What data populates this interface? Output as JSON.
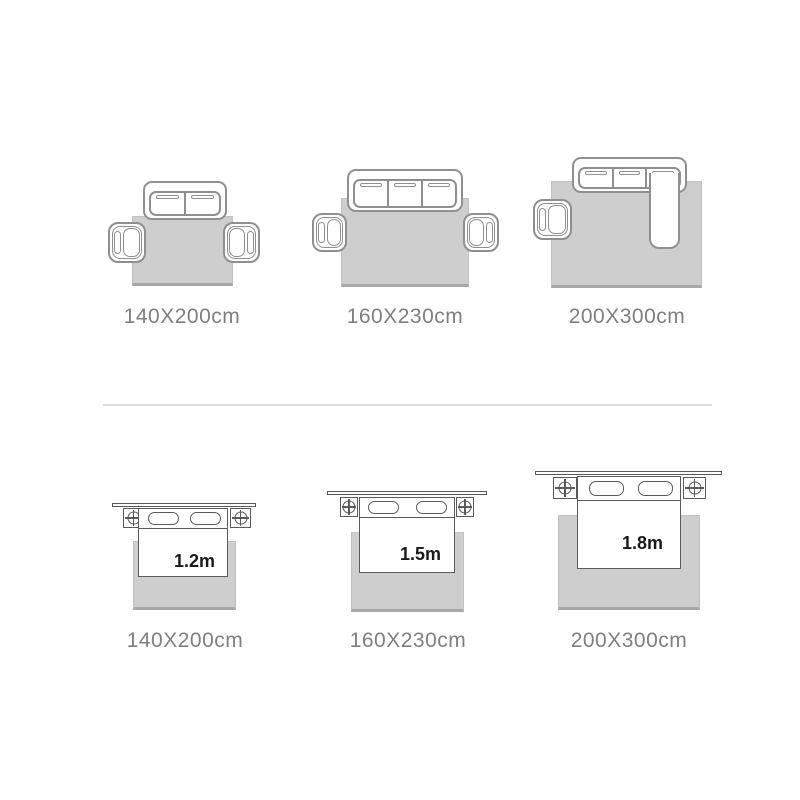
{
  "image": {
    "type": "rug-size-guide"
  },
  "colors": {
    "background": "#ffffff",
    "rug_fill": "#cecece",
    "sofa_outline": "#8f8f8f",
    "bed_outline": "#5a5a5a",
    "size_label_text": "#7f7f7f",
    "bed_width_text": "#1a1a1a"
  },
  "living_room_sizes": [
    {
      "rug_label": "140X200cm",
      "icon": "two-seat-sofa-with-two-armchairs"
    },
    {
      "rug_label": "160X230cm",
      "icon": "three-seat-sofa-with-two-armchairs"
    },
    {
      "rug_label": "200X300cm",
      "icon": "sectional-sofa-with-chaise-and-one-armchair"
    }
  ],
  "bedroom_sizes": [
    {
      "rug_label": "140X200cm",
      "bed_width": "1.2m"
    },
    {
      "rug_label": "160X230cm",
      "bed_width": "1.5m"
    },
    {
      "rug_label": "200X300cm",
      "bed_width": "1.8m"
    }
  ]
}
